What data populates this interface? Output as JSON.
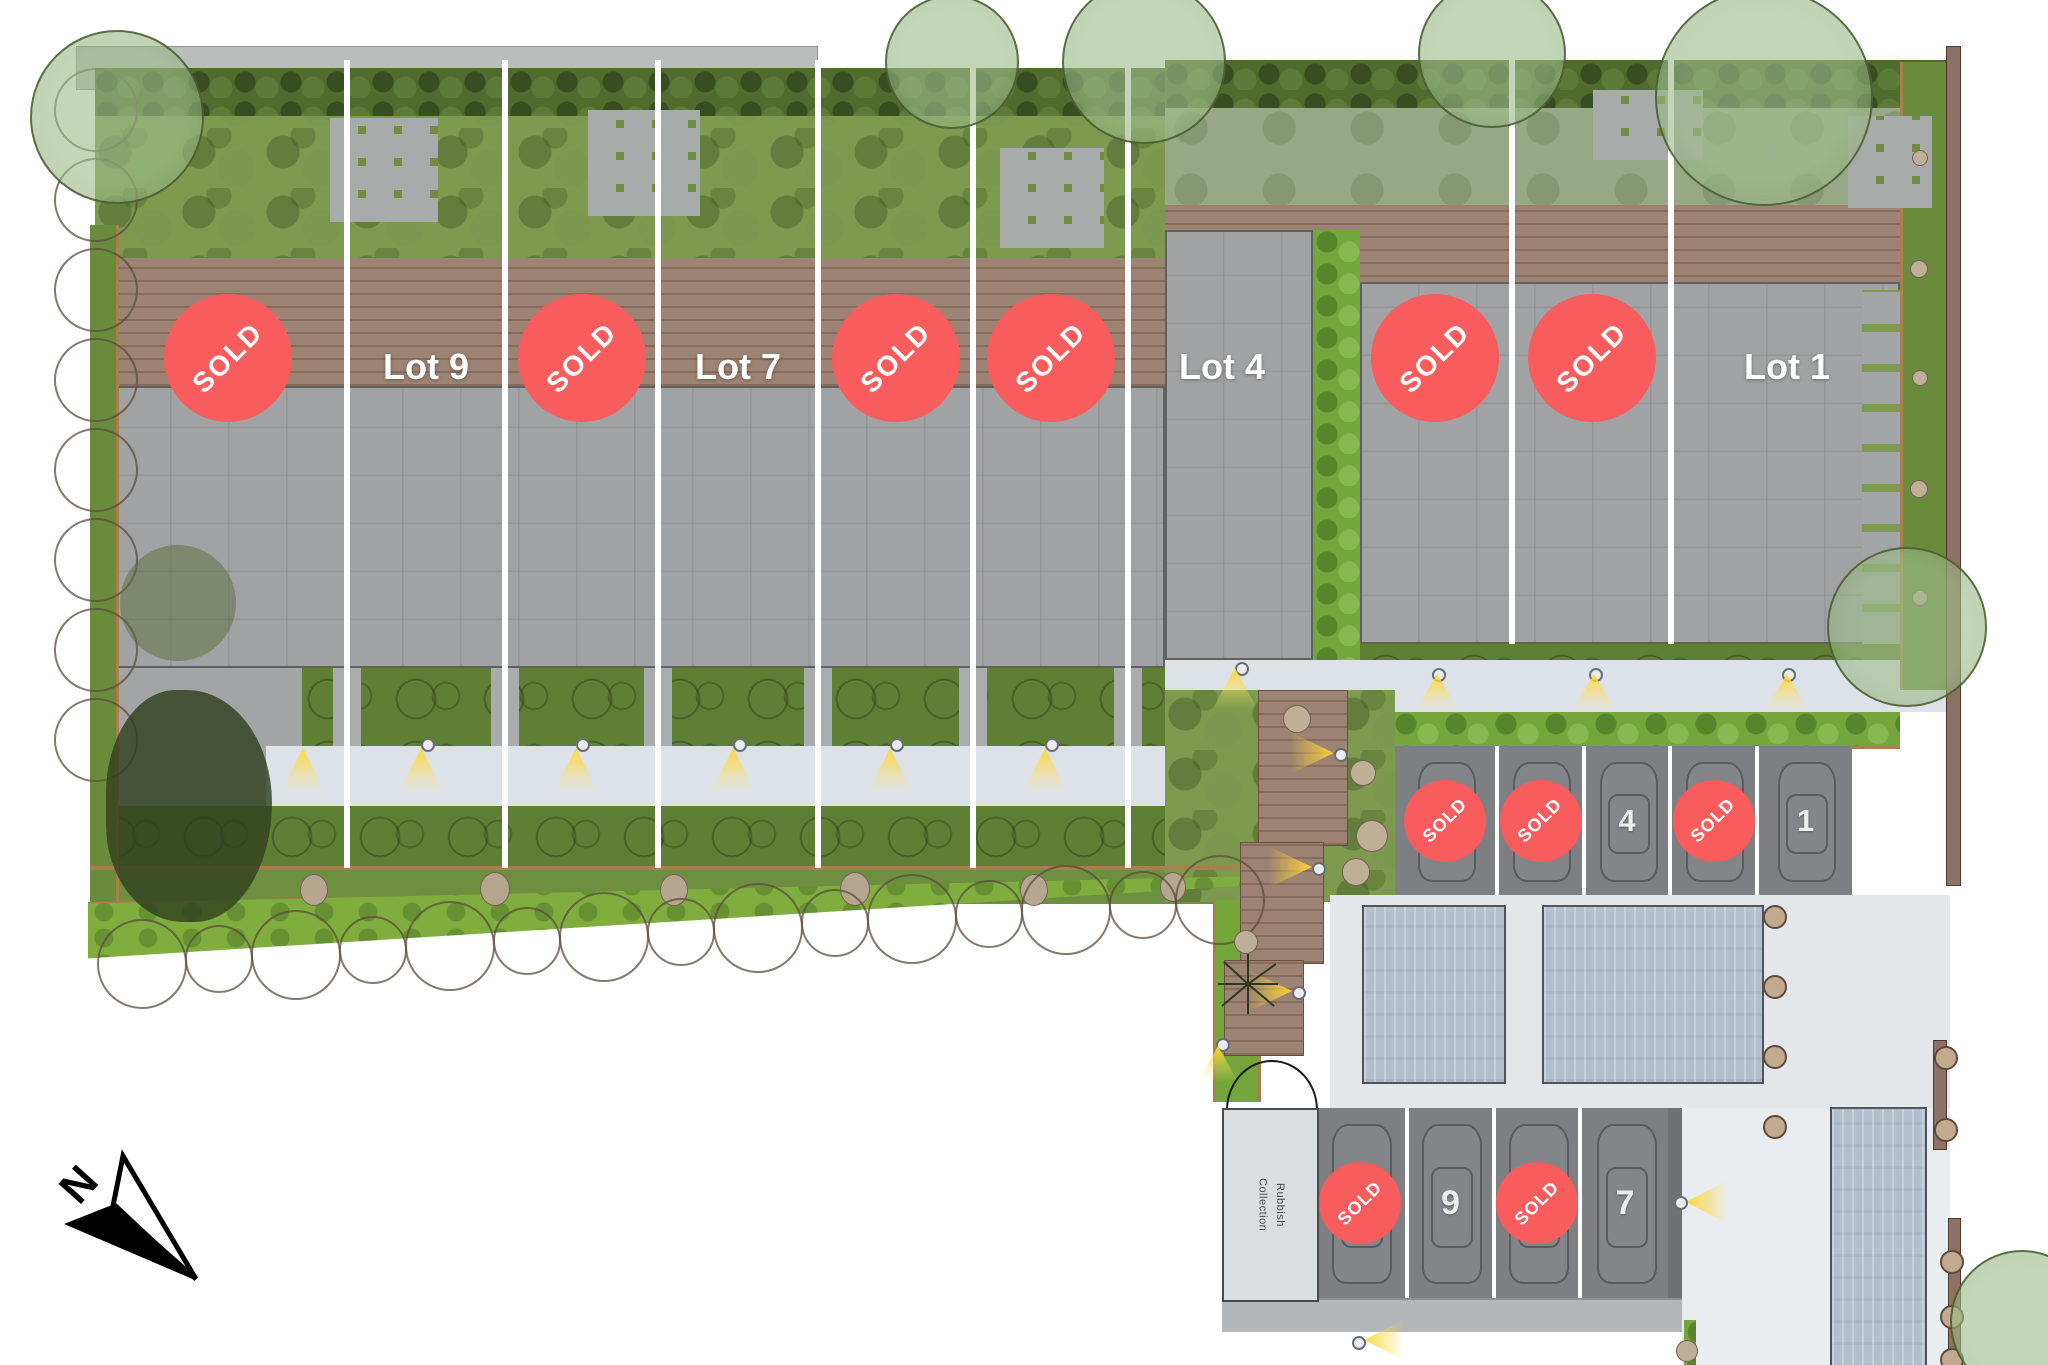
{
  "site": {
    "type": "residential-development-site-plan",
    "sold_text": "SOLD"
  },
  "terrace_row": [
    {
      "status": "sold",
      "badge": "SOLD"
    },
    {
      "status": "available",
      "label": "Lot 9"
    },
    {
      "status": "sold",
      "badge": "SOLD"
    },
    {
      "status": "available",
      "label": "Lot 7"
    },
    {
      "status": "sold",
      "badge": "SOLD"
    },
    {
      "status": "sold",
      "badge": "SOLD"
    },
    {
      "status": "available",
      "label": "Lot 4"
    },
    {
      "status": "sold",
      "badge": "SOLD"
    },
    {
      "status": "sold",
      "badge": "SOLD"
    },
    {
      "status": "available",
      "label": "Lot 1"
    }
  ],
  "upper_parking": {
    "stalls": [
      {
        "status": "sold",
        "badge": "SOLD"
      },
      {
        "status": "sold",
        "badge": "SOLD"
      },
      {
        "status": "available",
        "number": "4"
      },
      {
        "status": "sold",
        "badge": "SOLD"
      },
      {
        "status": "available",
        "number": "1"
      }
    ]
  },
  "lower_parking": {
    "stalls": [
      {
        "status": "sold",
        "badge": "SOLD"
      },
      {
        "status": "available",
        "number": "9"
      },
      {
        "status": "sold",
        "badge": "SOLD"
      },
      {
        "status": "available",
        "number": "7"
      }
    ]
  },
  "utility": {
    "rubbish_label": "Rubbish\nCollection"
  },
  "compass": {
    "north": "N"
  },
  "colors": {
    "sold_badge": "#f85c5c",
    "badge_text": "#ffffff",
    "lot_label_text": "#ffffff",
    "house_fill": "#a1a2a3",
    "deck_brown": "#9c8373",
    "garden_green": "#7d9a4e",
    "hedge_green": "#4f6b2e",
    "bright_hedge_green": "#74a63c",
    "walkway": "#dde2e9",
    "driveway": "#e4e7ea",
    "parking_surface": "#7d7f82",
    "garage_roof_blue": "#b2bfcc",
    "timber_edge": "#a97f4e",
    "fence_brown": "#8d7164",
    "light_yellow": "#ffd637",
    "north_arrow": "#000000"
  }
}
